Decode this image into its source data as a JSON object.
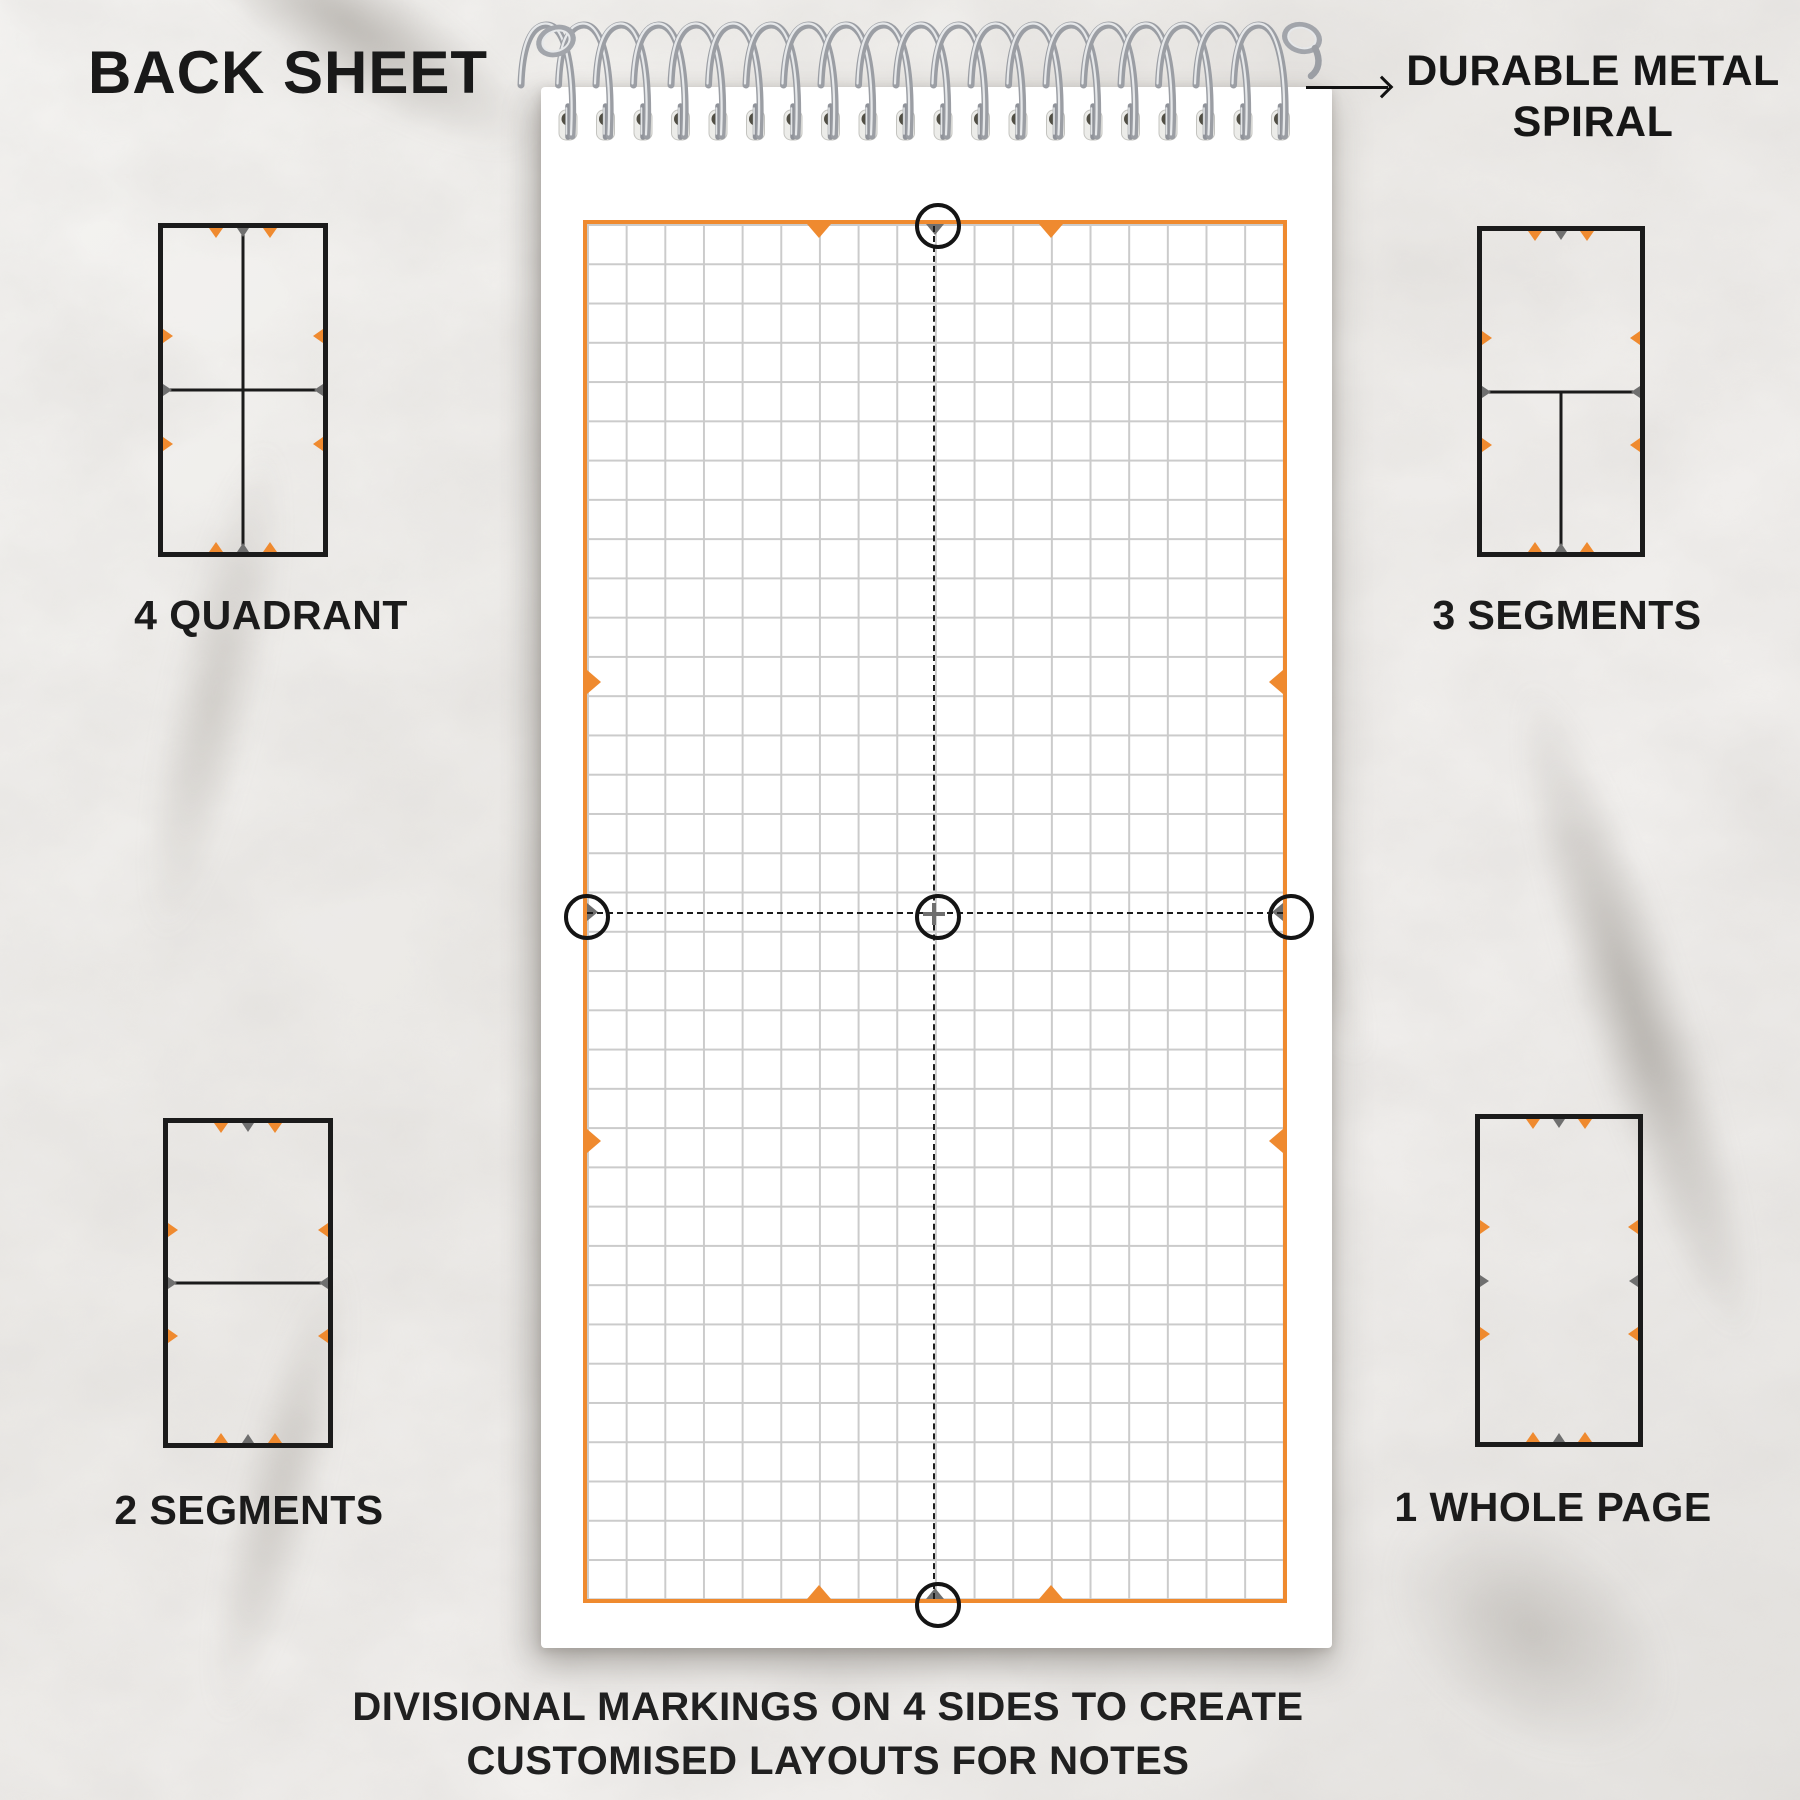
{
  "title": "BACK SHEET",
  "spiral_callout": {
    "line1": "DURABLE METAL",
    "line2": "SPIRAL"
  },
  "caption": {
    "line1": "DIVISIONAL MARKINGS ON 4 SIDES TO CREATE",
    "line2": "CUSTOMISED LAYOUTS FOR NOTES"
  },
  "layouts": [
    {
      "id": "four-quadrant",
      "label": "4 QUADRANT",
      "dividers": [
        "vertical-full",
        "horizontal-full"
      ]
    },
    {
      "id": "three-segments",
      "label": "3 SEGMENTS",
      "dividers": [
        "horizontal-full",
        "vertical-bottom-half"
      ]
    },
    {
      "id": "two-segments",
      "label": "2 SEGMENTS",
      "dividers": [
        "horizontal-full"
      ]
    },
    {
      "id": "one-whole-page",
      "label": "1 WHOLE PAGE",
      "dividers": []
    }
  ],
  "notepad": {
    "sheet_type": "square grid",
    "grid_columns": 18,
    "grid_rows": 35,
    "division_marker_fractions": [
      "1/3",
      "1/2",
      "2/3"
    ],
    "spiral_loops": 20
  },
  "colors": {
    "accent_orange": "#ef8a2f",
    "marker_gray": "#6f6f6f",
    "ink_black": "#1b1b1b",
    "grid_line": "#cbcbcb"
  }
}
